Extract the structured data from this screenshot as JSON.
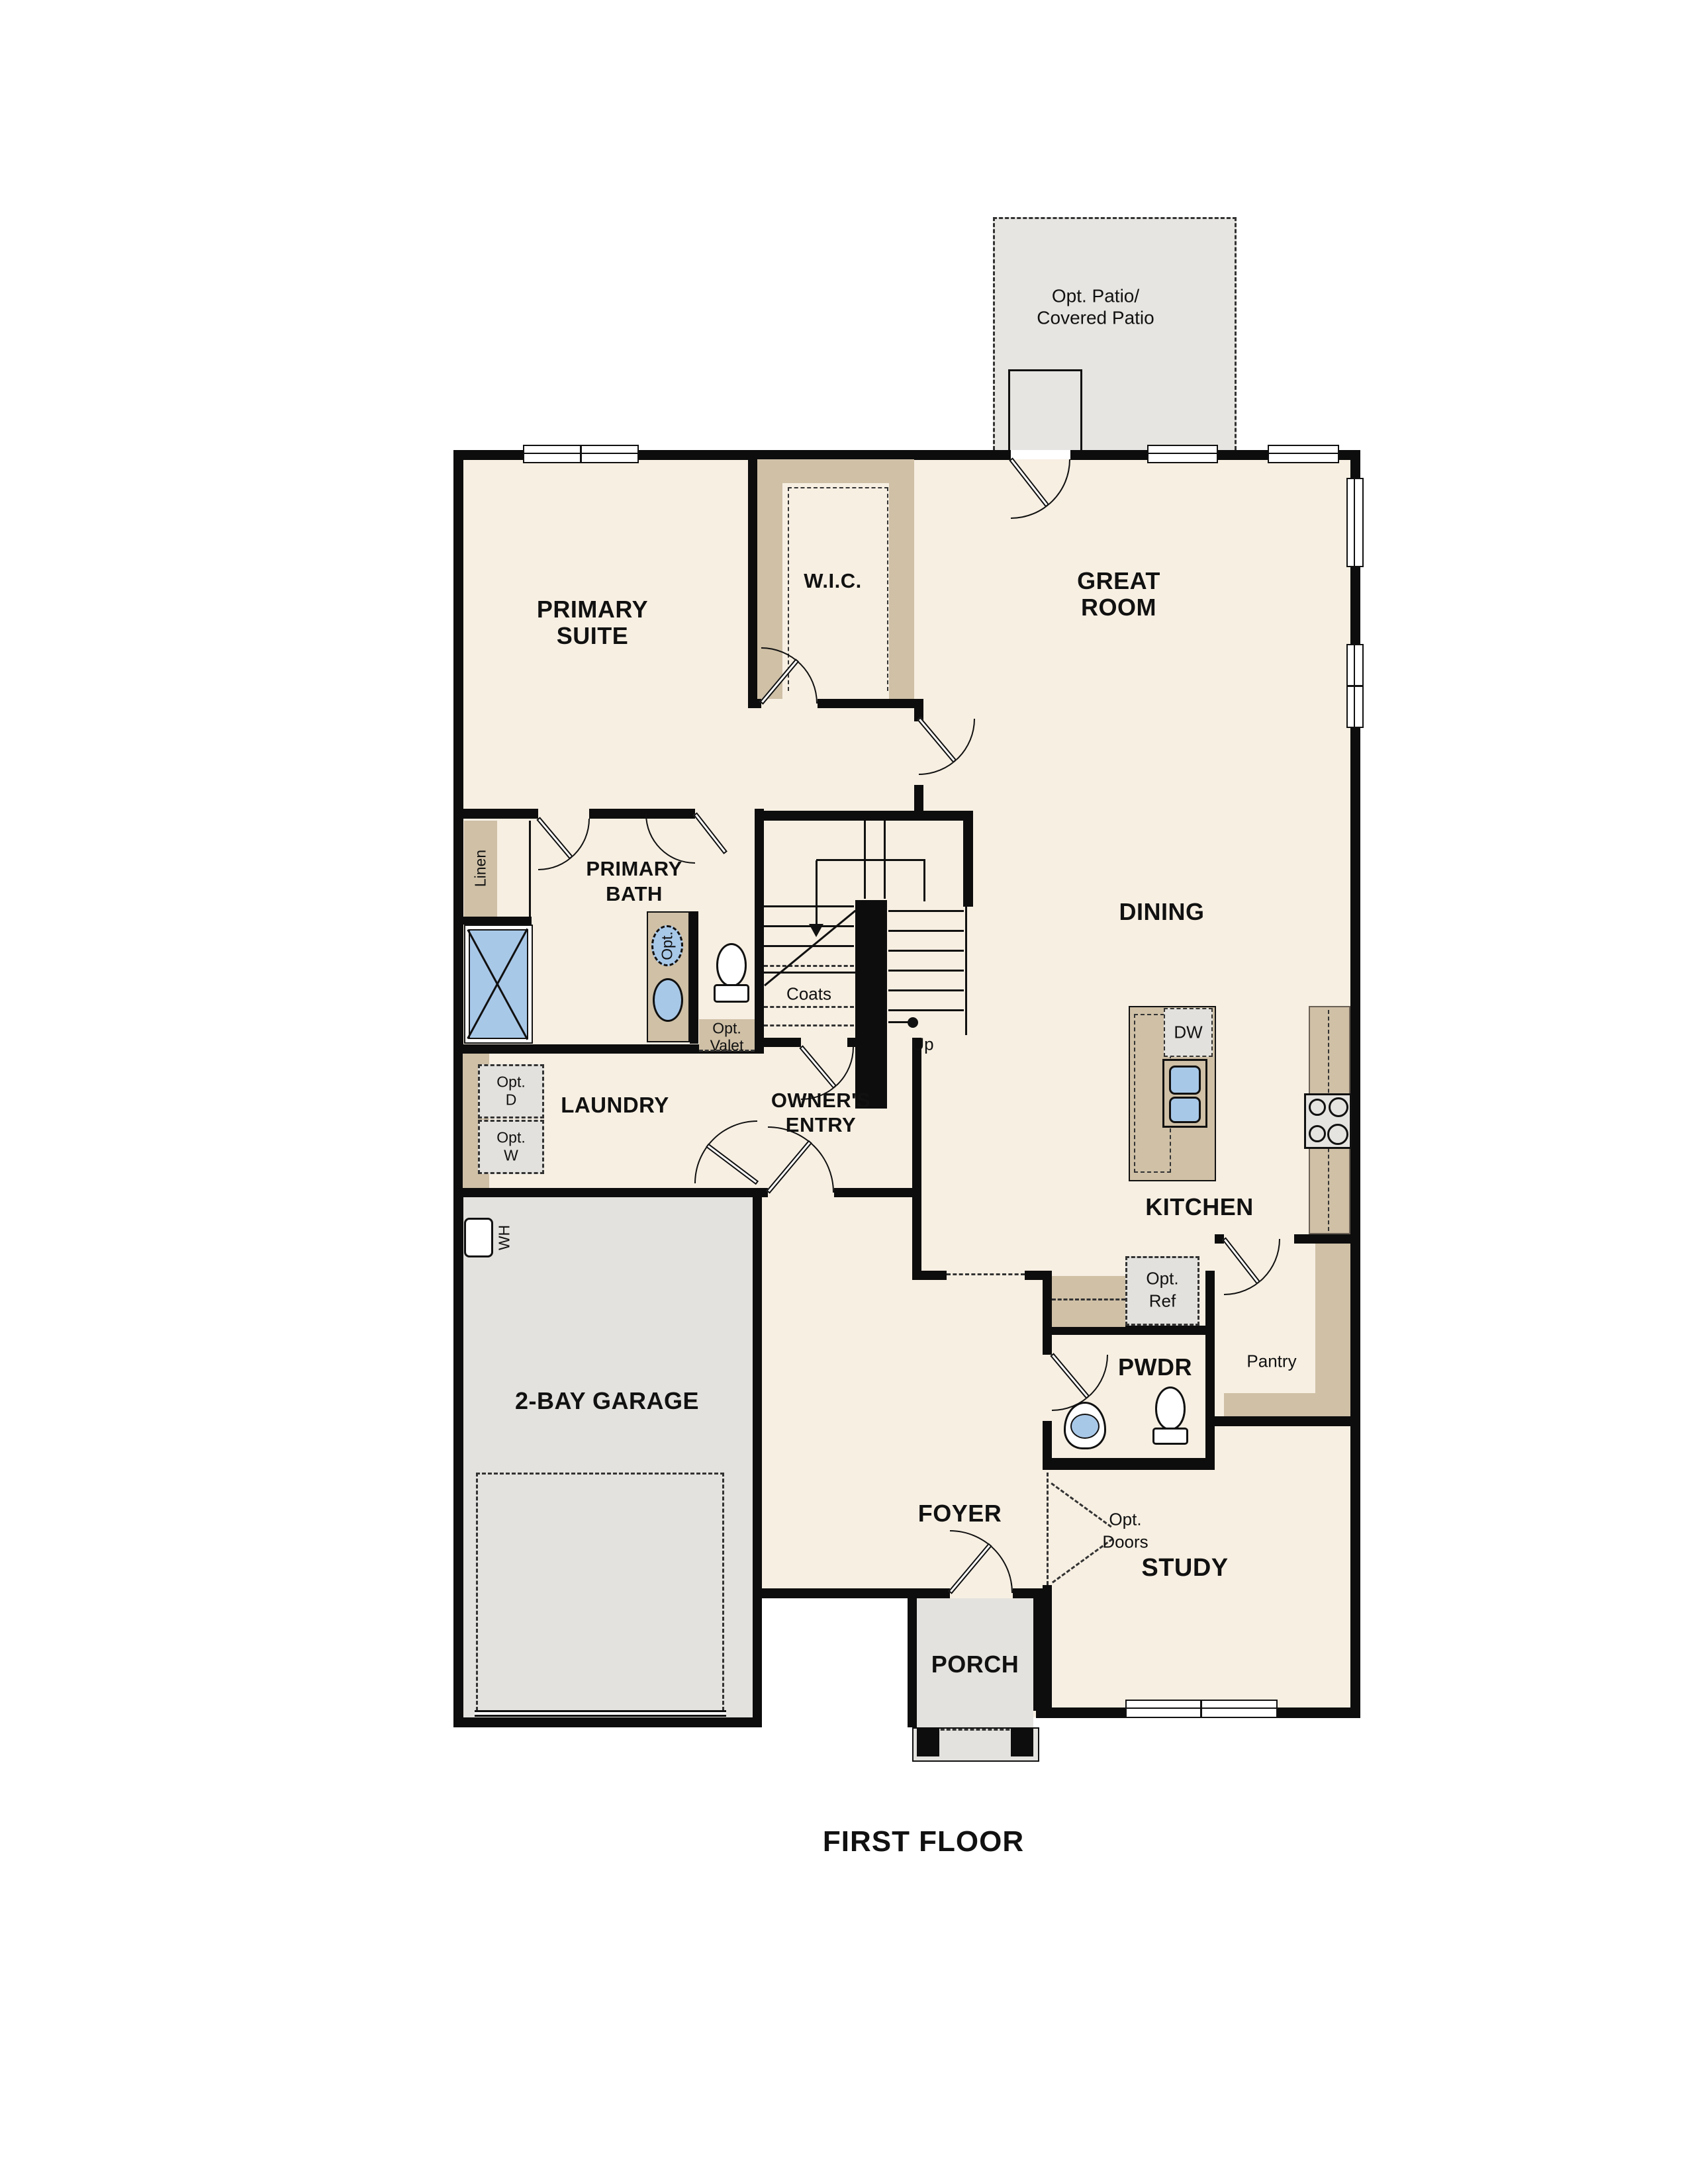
{
  "title": "FIRST FLOOR",
  "colors": {
    "floor_cream": "#f7efe2",
    "floor_gray": "#e4e2de",
    "cabinet_tan": "#cfc0a6",
    "fixture_blue": "#a8c8e8",
    "wall_black": "#0d0d0d"
  },
  "rooms": {
    "patio": {
      "line1": "Opt. Patio/",
      "line2": "Covered Patio"
    },
    "primary_suite": {
      "line1": "PRIMARY",
      "line2": "SUITE"
    },
    "wic": {
      "label": "W.I.C."
    },
    "great_room": {
      "line1": "GREAT",
      "line2": "ROOM"
    },
    "dining": {
      "label": "DINING"
    },
    "primary_bath": {
      "line1": "PRIMARY",
      "line2": "BATH"
    },
    "laundry": {
      "label": "LAUNDRY"
    },
    "owners_entry": {
      "line1": "OWNER'S",
      "line2": "ENTRY"
    },
    "kitchen": {
      "label": "KITCHEN"
    },
    "garage": {
      "label": "2-BAY GARAGE"
    },
    "foyer": {
      "label": "FOYER"
    },
    "pwdr": {
      "label": "PWDR"
    },
    "pantry": {
      "label": "Pantry"
    },
    "study": {
      "label": "STUDY"
    },
    "porch": {
      "label": "PORCH"
    }
  },
  "features": {
    "linen": "Linen",
    "coats": "Coats",
    "up": "Up",
    "wh": "WH",
    "dw": "DW",
    "opt_tub": "Opt.",
    "opt_valet": {
      "line1": "Opt.",
      "line2": "Valet"
    },
    "opt_d": {
      "line1": "Opt.",
      "line2": "D"
    },
    "opt_w": {
      "line1": "Opt.",
      "line2": "W"
    },
    "opt_ref": {
      "line1": "Opt.",
      "line2": "Ref"
    },
    "opt_doors": {
      "line1": "Opt.",
      "line2": "Doors"
    }
  }
}
